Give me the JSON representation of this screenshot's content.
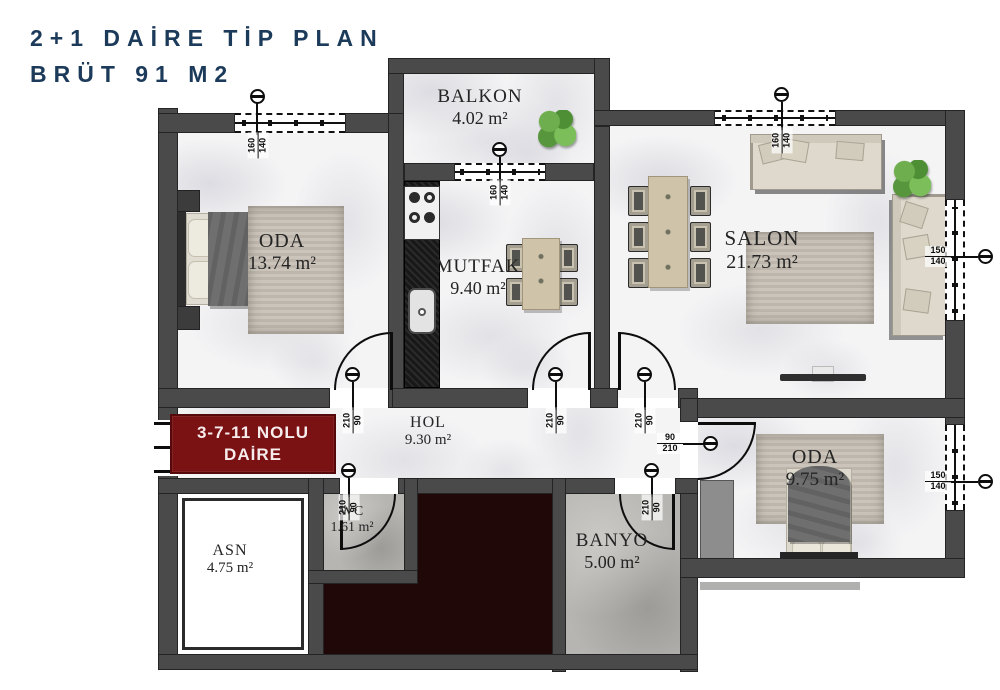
{
  "title": {
    "line1": "2+1 DAİRE TİP PLAN",
    "line2": "BRÜT 91 M2"
  },
  "unit_badge": {
    "line1": "3-7-11 NOLU",
    "line2": "DAİRE"
  },
  "rooms": {
    "balkon": {
      "name": "BALKON",
      "area": "4.02 m²"
    },
    "oda1": {
      "name": "ODA",
      "area": "13.74 m²"
    },
    "mutfak": {
      "name": "MUTFAK",
      "area": "9.40 m²"
    },
    "salon": {
      "name": "SALON",
      "area": "21.73 m²"
    },
    "hol": {
      "name": "HOL",
      "area": "9.30 m²"
    },
    "asn": {
      "name": "ASN",
      "area": "4.75 m²"
    },
    "wc": {
      "name": "WC",
      "area": "1.61 m²"
    },
    "banyo": {
      "name": "BANYO",
      "area": "5.00 m²"
    },
    "oda2": {
      "name": "ODA",
      "area": "9.75 m²"
    }
  },
  "dims": {
    "oda1_window": {
      "a": "160",
      "b": "140"
    },
    "balkon_window": {
      "a": "160",
      "b": "140"
    },
    "salon_window_top": {
      "a": "160",
      "b": "140"
    },
    "salon_window_right": {
      "a": "150",
      "b": "140"
    },
    "oda2_window": {
      "a": "150",
      "b": "140"
    },
    "oda1_door": {
      "a": "210",
      "b": "90"
    },
    "mutfak_door": {
      "a": "210",
      "b": "90"
    },
    "salon_door": {
      "a": "210",
      "b": "90"
    },
    "wc_door": {
      "a": "210",
      "b": "90"
    },
    "banyo_door": {
      "a": "210",
      "b": "90"
    },
    "oda2_door": {
      "a": "90",
      "b": "210"
    }
  },
  "colors": {
    "title_text": "#1c3a59",
    "badge_bg": "#7a1113",
    "wall": "#4a4a4a",
    "core_area": "#200808",
    "floor_marble": "#f4f4f5",
    "floor_tile": "#b6b5b1"
  }
}
